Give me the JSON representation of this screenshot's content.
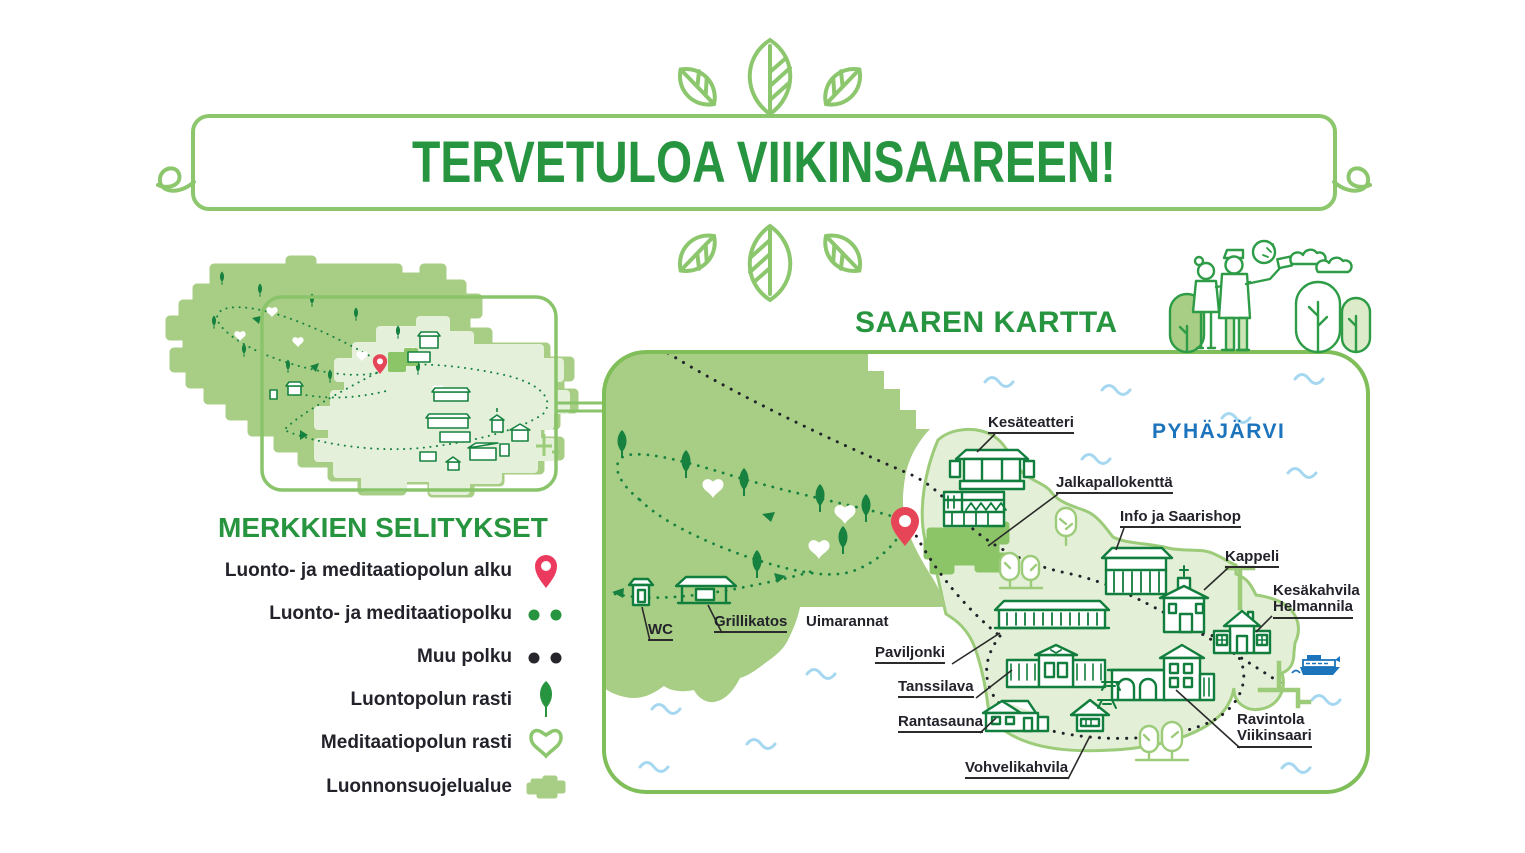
{
  "banner": {
    "title": "TERVETULOA VIIKINSAAREEN!"
  },
  "map": {
    "title": "SAAREN KARTTA",
    "lake_name": "PYHÄJÄRVI",
    "labels": {
      "kesateatteri": "Kesäteatteri",
      "jalkapallokentta": "Jalkapallokenttä",
      "info": "Info ja Saarishop",
      "kappeli": "Kappeli",
      "helmannila_line1": "Kesäkahvila",
      "helmannila_line2": "Helmannila",
      "wc": "WC",
      "grillikatos": "Grillikatos",
      "uimarannat": "Uimarannat",
      "paviljonki": "Paviljonki",
      "tanssilava": "Tanssilava",
      "rantasauna": "Rantasauna",
      "vohvelikahvila": "Vohvelikahvila",
      "ravintola_line1": "Ravintola",
      "ravintola_line2": "Viikinsaari"
    }
  },
  "legend": {
    "title": "MERKKIEN SELITYKSET",
    "items": [
      {
        "label": "Luonto- ja meditaatiopolun alku",
        "icon": "pin-icon"
      },
      {
        "label": "Luonto- ja meditaatiopolku",
        "icon": "green-dots-icon"
      },
      {
        "label": "Muu polku",
        "icon": "black-dots-icon"
      },
      {
        "label": "Luontopolun rasti",
        "icon": "leaf-icon"
      },
      {
        "label": "Meditaatiopolun rasti",
        "icon": "heart-icon"
      },
      {
        "label": "Luonnonsuojelualue",
        "icon": "nature-reserve-patch-icon"
      }
    ]
  },
  "colors": {
    "heading_green": "#27953F",
    "lineart_green": "#117E3D",
    "border_light_green": "#8CC76D",
    "reserve_fill": "#A8CE85",
    "island_fill": "#E3EFD6",
    "island_outline": "#9CCB79",
    "field_fill": "#8CC468",
    "pin_red": "#E8425A",
    "label_ink": "#22222A",
    "lake_blue": "#1B74BC",
    "wave_blue": "#A5D8F0"
  }
}
